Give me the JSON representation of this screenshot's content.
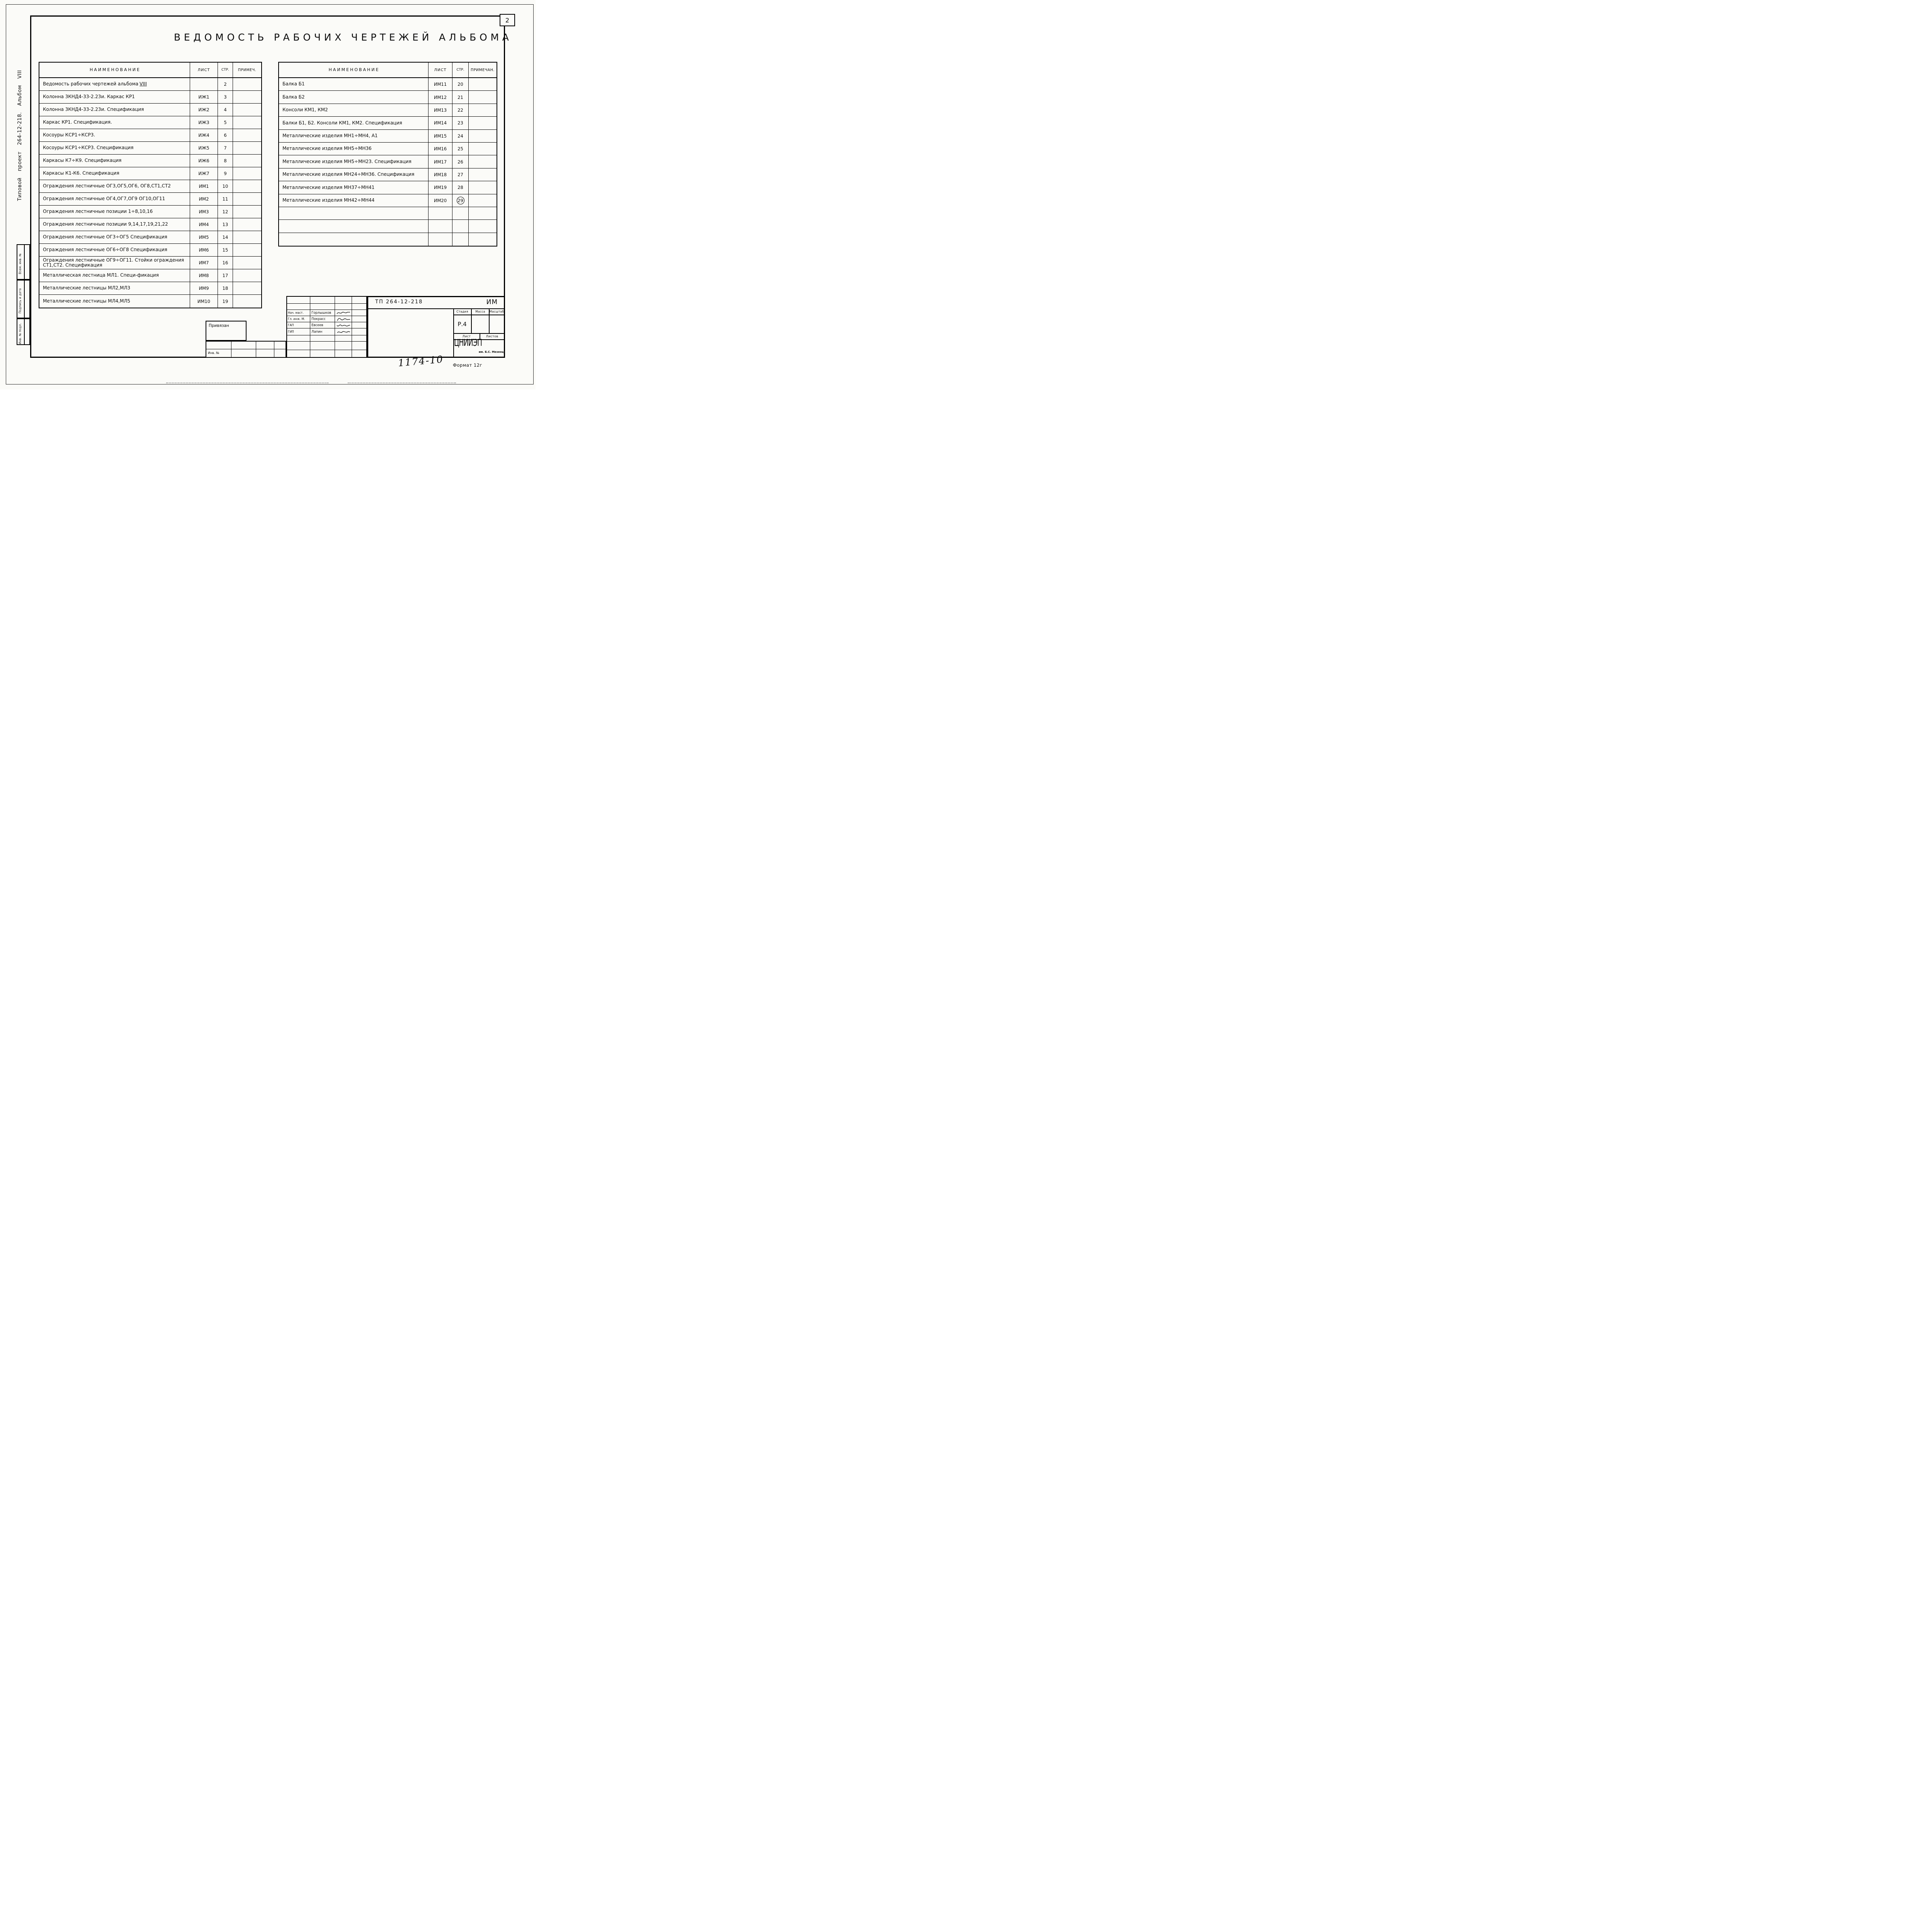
{
  "page": {
    "sheet_number": "2",
    "title": "ВЕДОМОСТЬ РАБОЧИХ ЧЕРТЕЖЕЙ АЛЬБОМА",
    "footer_number": "1174-10",
    "format_label": "Формат 12г"
  },
  "margin": {
    "project_label": "Типовой проект 264-12-218. Альбом VIII",
    "stamps": [
      "Взам. инв. №",
      "Подпись и дата",
      "Инв. № подл."
    ]
  },
  "left_table": {
    "headers": [
      "НАИМЕНОВАНИЕ",
      "ЛИСТ",
      "СТР.",
      "ПРИМЕЧ."
    ],
    "rows": [
      {
        "name": "Ведомость рабочих чертежей альбома",
        "suffix": "VIII",
        "sheet": "",
        "page": "2",
        "note": ""
      },
      {
        "name": "Колонна 3КНД4-33-2.23и. Каркас КР1",
        "suffix": "",
        "sheet": "ИЖ1",
        "page": "3",
        "note": ""
      },
      {
        "name": "Колонна 3КНД4-33-2.23и. Спецификация",
        "suffix": "",
        "sheet": "ИЖ2",
        "page": "4",
        "note": ""
      },
      {
        "name": "Каркас КР1. Спецификация.",
        "suffix": "",
        "sheet": "ИЖ3",
        "page": "5",
        "note": ""
      },
      {
        "name": "Косоуры КСР1÷КСР3.",
        "suffix": "",
        "sheet": "ИЖ4",
        "page": "6",
        "note": ""
      },
      {
        "name": "Косоуры КСР1÷КСР3. Спецификация",
        "suffix": "",
        "sheet": "ИЖ5",
        "page": "7",
        "note": ""
      },
      {
        "name": "Каркасы К7÷К9. Спецификация",
        "suffix": "",
        "sheet": "ИЖ6",
        "page": "8",
        "note": ""
      },
      {
        "name": "Каркасы К1-К6. Спецификация",
        "suffix": "",
        "sheet": "ИЖ7",
        "page": "9",
        "note": ""
      },
      {
        "name": "Ограждения лестничные ОГ3,ОГ5,ОГ6, ОГ8,СТ1,СТ2",
        "suffix": "",
        "sheet": "ИМ1",
        "page": "10",
        "note": ""
      },
      {
        "name": "Ограждения лестничные ОГ4,ОГ7,ОГ9 ОГ10,ОГ11",
        "suffix": "",
        "sheet": "ИМ2",
        "page": "11",
        "note": ""
      },
      {
        "name": "Ограждения лестничные позиции 1÷8,10,16",
        "suffix": "",
        "sheet": "ИМ3",
        "page": "12",
        "note": ""
      },
      {
        "name": "Ограждения лестничные позиции 9,14,17,19,21,22",
        "suffix": "",
        "sheet": "ИМ4",
        "page": "13",
        "note": ""
      },
      {
        "name": "Ограждения лестничные ОГ3÷ОГ5 Спецификация",
        "suffix": "",
        "sheet": "ИМ5",
        "page": "14",
        "note": ""
      },
      {
        "name": "Ограждения лестничные ОГ6÷ОГ8 Спецификация",
        "suffix": "",
        "sheet": "ИМ6",
        "page": "15",
        "note": ""
      },
      {
        "name": "Ограждения лестничные ОГ9÷ОГ11. Стойки ограждения СТ1,СТ2. Спецификация",
        "suffix": "",
        "sheet": "ИМ7",
        "page": "16",
        "note": ""
      },
      {
        "name": "Металлическая лестница МЛ1. Специ-фикация",
        "suffix": "",
        "sheet": "ИМ8",
        "page": "17",
        "note": ""
      },
      {
        "name": "Металлические лестницы МЛ2,МЛ3",
        "suffix": "",
        "sheet": "ИМ9",
        "page": "18",
        "note": ""
      },
      {
        "name": "Металлические лестницы МЛ4,МЛ5",
        "suffix": "",
        "sheet": "ИМ10",
        "page": "19",
        "note": ""
      }
    ]
  },
  "right_table": {
    "headers": [
      "НАИМЕНОВАНИЕ",
      "ЛИСТ",
      "СТР.",
      "ПРИМЕЧАН."
    ],
    "rows": [
      {
        "name": "Балка Б1",
        "suffix": "",
        "sheet": "ИМ11",
        "page": "20",
        "note": ""
      },
      {
        "name": "Балка Б2",
        "suffix": "",
        "sheet": "ИМ12",
        "page": "21",
        "note": ""
      },
      {
        "name": "Консоли КМ1, КМ2",
        "suffix": "",
        "sheet": "ИМ13",
        "page": "22",
        "note": ""
      },
      {
        "name": "Балки Б1, Б2. Консоли КМ1, КМ2. Спецификация",
        "suffix": "",
        "sheet": "ИМ14",
        "page": "23",
        "note": ""
      },
      {
        "name": "Металлические изделия МН1÷МН4, А1",
        "suffix": "",
        "sheet": "ИМ15",
        "page": "24",
        "note": ""
      },
      {
        "name": "Металлические изделия МН5÷МН36",
        "suffix": "",
        "sheet": "ИМ16",
        "page": "25",
        "note": ""
      },
      {
        "name": "Металлические изделия МН5÷МН23. Спецификация",
        "suffix": "",
        "sheet": "ИМ17",
        "page": "26",
        "note": ""
      },
      {
        "name": "Металлические изделия МН24÷МН36. Спецификация",
        "suffix": "",
        "sheet": "ИМ18",
        "page": "27",
        "note": ""
      },
      {
        "name": "Металлические изделия МН37÷МН41",
        "suffix": "",
        "sheet": "ИМ19",
        "page": "28",
        "note": ""
      },
      {
        "name": "Металлические изделия МН42÷МН44",
        "suffix": "",
        "sheet": "ИМ20",
        "page": "29",
        "note": "",
        "circled": true
      },
      {
        "name": "",
        "suffix": "",
        "sheet": "",
        "page": "",
        "note": ""
      },
      {
        "name": "",
        "suffix": "",
        "sheet": "",
        "page": "",
        "note": ""
      },
      {
        "name": "",
        "suffix": "",
        "sheet": "",
        "page": "",
        "note": ""
      }
    ]
  },
  "title_block": {
    "project_code": "ТП 264-12-218",
    "album_code": "ИМ",
    "attach_label": "Привязан",
    "inv_label": "Инв. №",
    "staff": [
      {
        "role": "Нач. маст.",
        "name": "Горлышков"
      },
      {
        "role": "Гл. инж. М.",
        "name": "Покрасс"
      },
      {
        "role": "ГАП",
        "name": "Евсеев"
      },
      {
        "role": "ГИП",
        "name": "Лапин"
      }
    ],
    "stage_headers": [
      "Стадия",
      "Масса",
      "Масштаб"
    ],
    "stage_value": "Р.4",
    "sheet_label": "Лист",
    "sheets_label": "Листов",
    "org_name": "ЦНИИЭП",
    "org_suffix": "им. Б.С. Мезенцева"
  }
}
